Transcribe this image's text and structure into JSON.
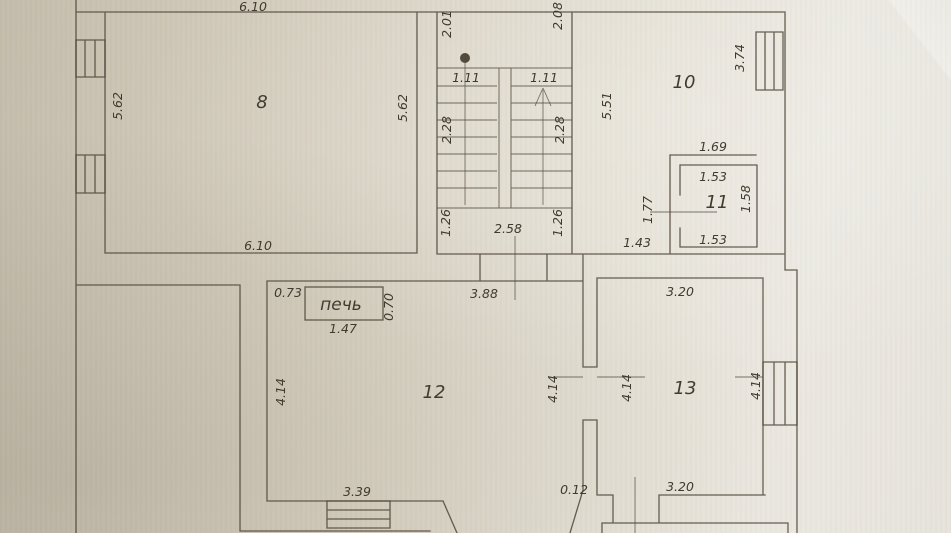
{
  "labels": {
    "room8_width_top": "6.10",
    "landing_width_left": "2.01",
    "landing_width_right": "2.08",
    "room8_height_left": "5.62",
    "room8_number": "8",
    "room8_height_right": "5.62",
    "stair_flight_left_width": "1.11",
    "stair_flight_right_width": "1.11",
    "stairwell_height": "5.51",
    "room10_number": "10",
    "room10_window_dim": "3.74",
    "stair_flight_left_length": "2.28",
    "stair_flight_right_length": "2.28",
    "room11_outer_width": "1.69",
    "room11_width_top": "1.53",
    "room11_door_dim": "1.77",
    "room11_number": "11",
    "room11_height_right": "1.58",
    "landing_depth_left": "1.26",
    "landing_width_bottom": "2.58",
    "landing_depth_right": "1.26",
    "corridor_width": "1.43",
    "room11_width_bottom": "1.53",
    "room8_width_bottom": "6.10",
    "stove_offset": "0.73",
    "stove_label": "печь",
    "stove_depth": "0.70",
    "stove_width": "1.47",
    "room12_width_top": "3.88",
    "room13_width_top": "3.20",
    "room12_height_left": "4.14",
    "room12_number": "12",
    "room12_height_right": "4.14",
    "room13_height_left": "4.14",
    "room13_number": "13",
    "room13_height_right": "4.14",
    "room12_width_bottom": "3.39",
    "gap_dim": "0.12",
    "room13_width_bottom": "3.20"
  },
  "colors": {
    "paper_dark": "#c3bcab",
    "paper_light": "#ebe8e1",
    "ink": "#50483a",
    "text_ink": "#3e382c"
  }
}
